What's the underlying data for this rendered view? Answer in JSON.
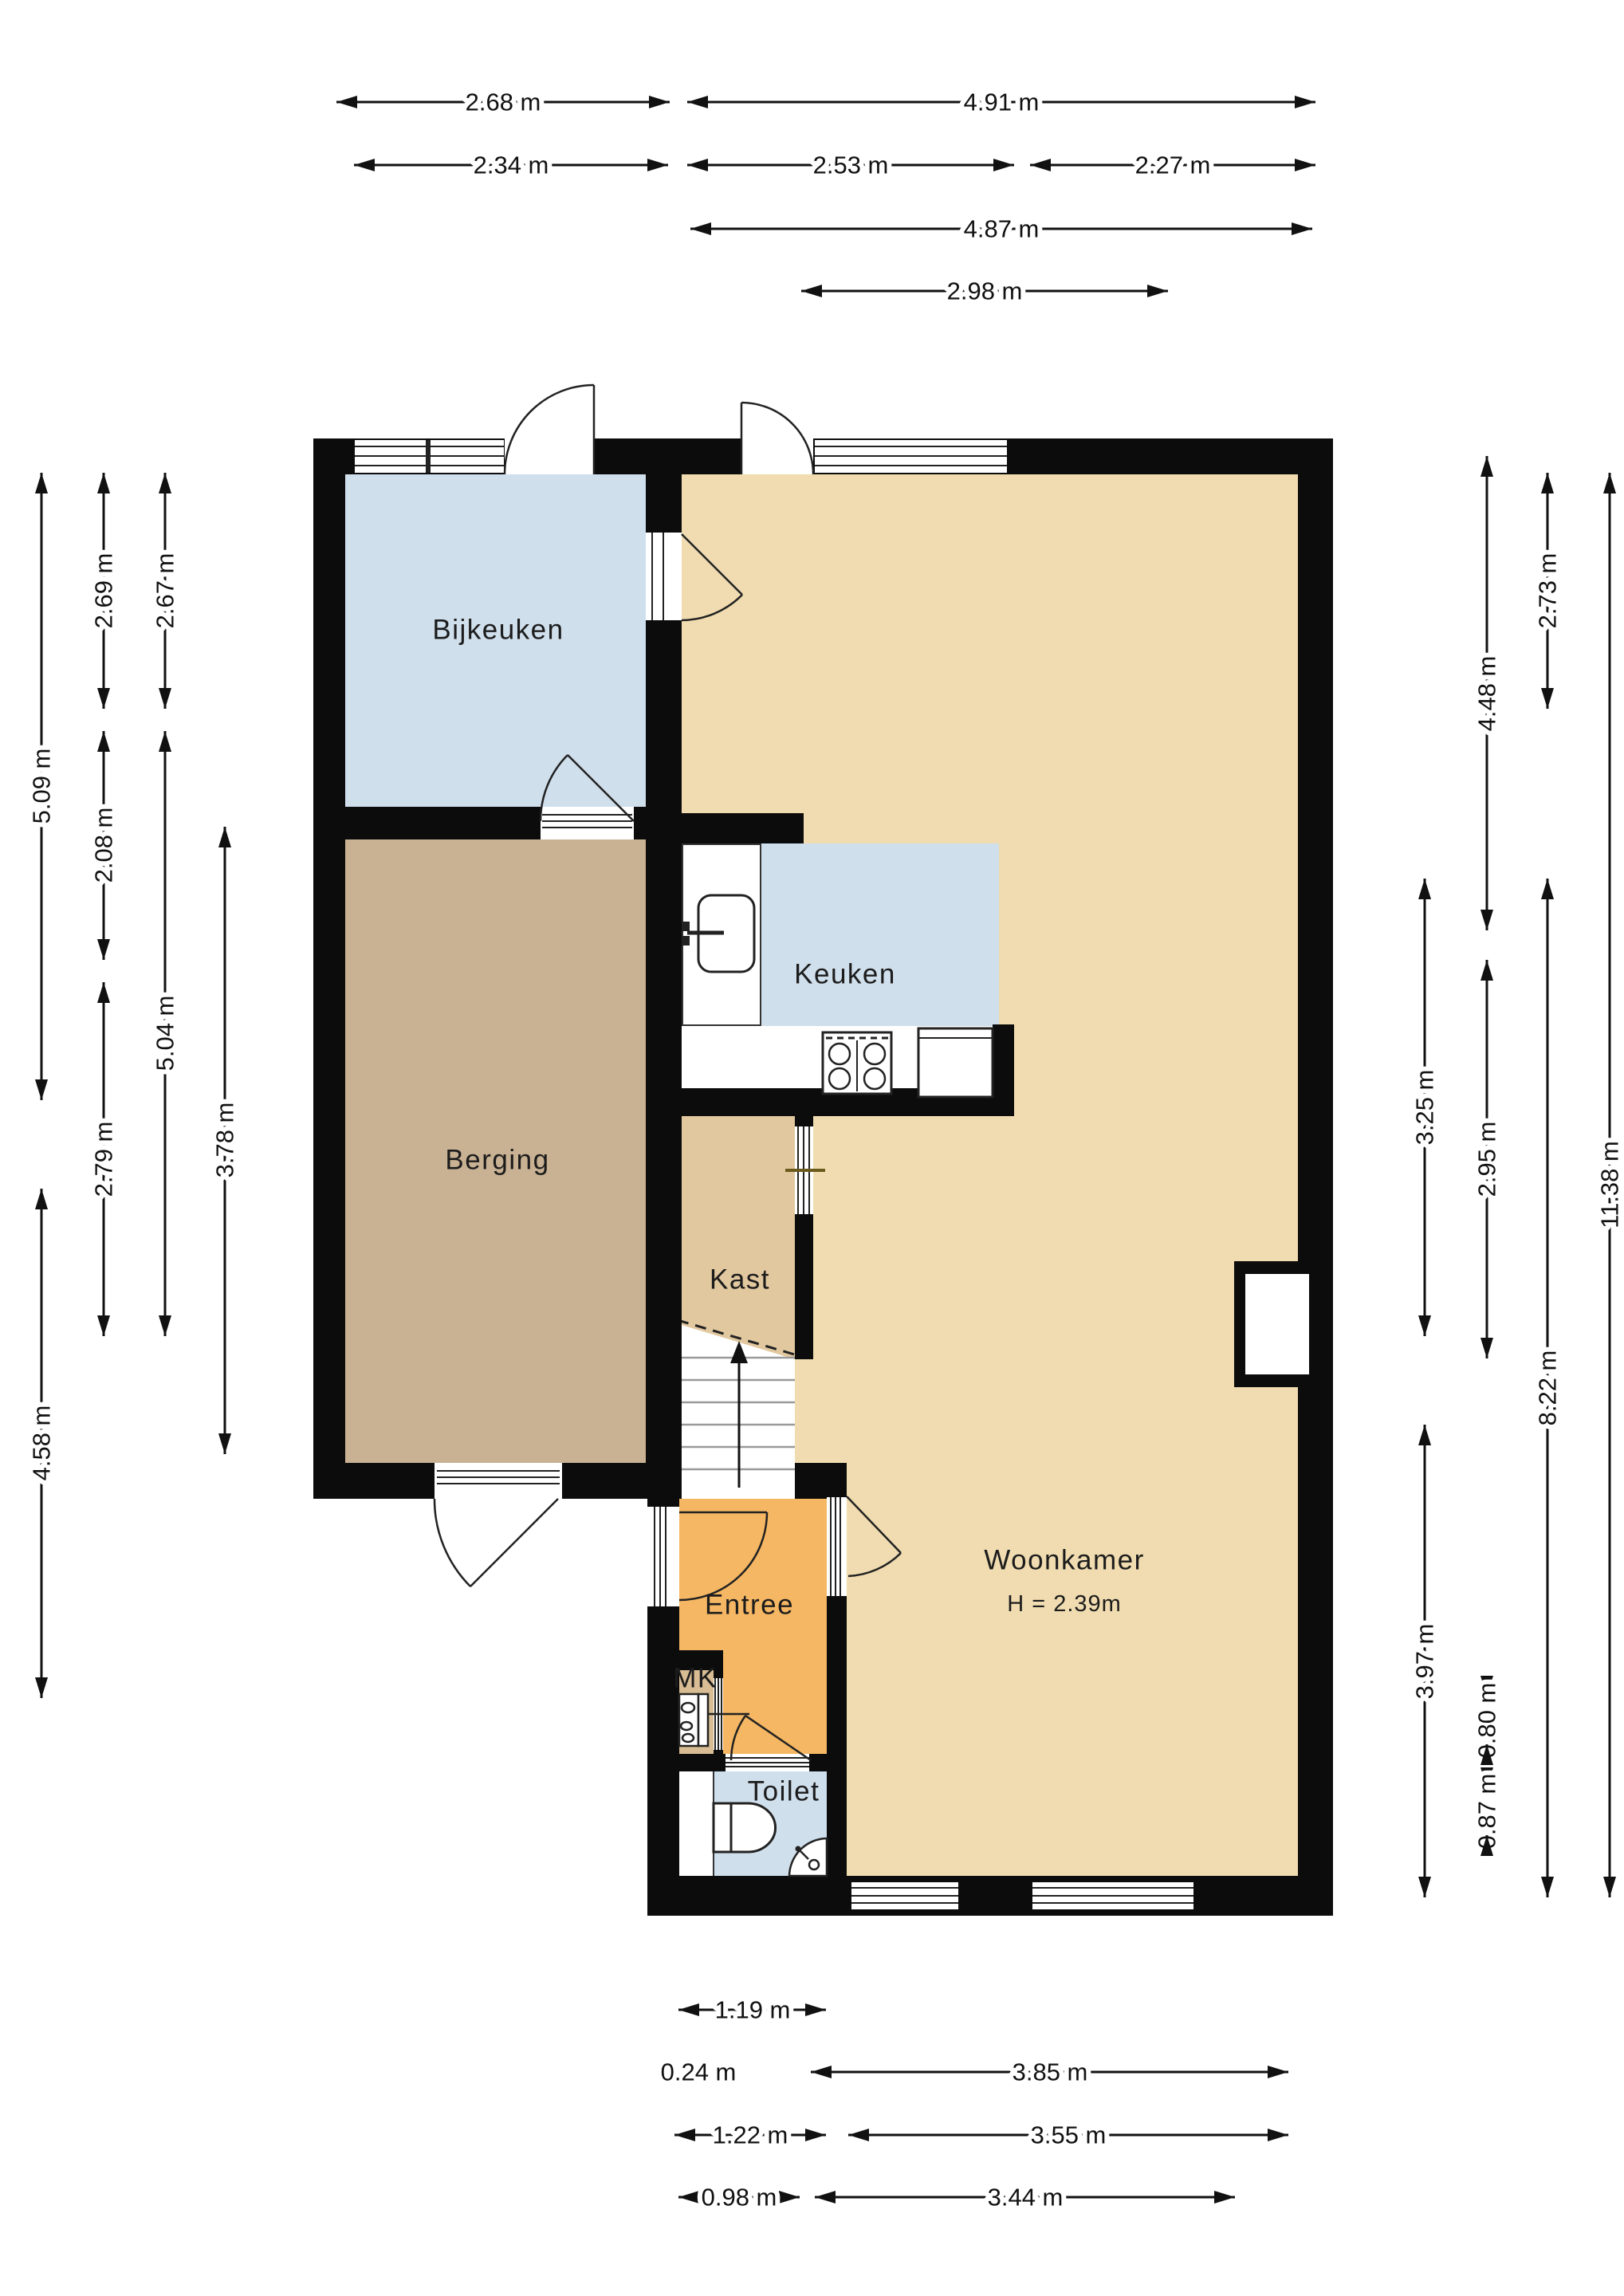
{
  "rooms": {
    "bijkeuken": {
      "label": "Bijkeuken"
    },
    "keuken": {
      "label": "Keuken"
    },
    "berging": {
      "label": "Berging"
    },
    "kast": {
      "label": "Kast"
    },
    "entree": {
      "label": "Entree"
    },
    "woonkamer": {
      "label": "Woonkamer",
      "ceiling_height": "H = 2.39m"
    },
    "toilet": {
      "label": "Toilet"
    },
    "mk": {
      "label": "MK"
    }
  },
  "dimensions": {
    "top": [
      "2.68 m",
      "4.91 m",
      "2.34 m",
      "2.53 m",
      "2.27 m",
      "4.87 m",
      "2.98 m"
    ],
    "left": [
      "5.09 m",
      "4.58 m",
      "2.69 m",
      "2.08 m",
      "2.79 m",
      "2.67 m",
      "5.04 m",
      "3.78 m"
    ],
    "right": [
      "3.25 m",
      "3.97 m",
      "4.48 m",
      "2.95 m",
      "2.73 m",
      "8.22 m",
      "11.38 m",
      "0.80 m",
      "0.87 m"
    ],
    "bottom": [
      "1.19 m",
      "0.24 m",
      "3.85 m",
      "1.22 m",
      "3.55 m",
      "0.98 m",
      "3.44 m"
    ]
  },
  "colors": {
    "wall": "#0c0c0c",
    "wet_room": "#d0dfec",
    "berging": "#c9b293",
    "kast": "#e2c89f",
    "woonkamer": "#f0dcb0",
    "entree": "#f5b763",
    "mk": "#d8bc93",
    "background": "#ffffff"
  }
}
